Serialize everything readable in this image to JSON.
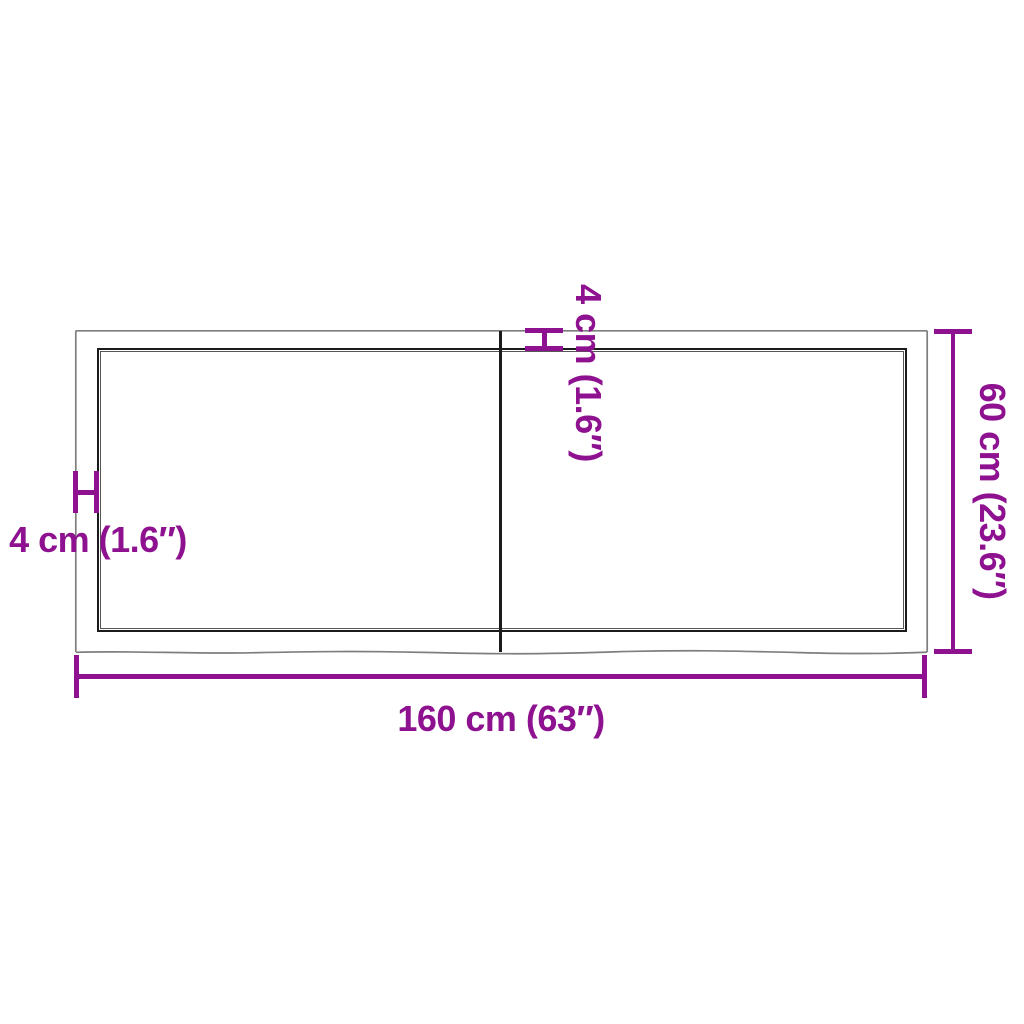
{
  "diagram": {
    "width_label": "160 cm (63″)",
    "height_label": "60 cm (23.6″)",
    "thickness_label_left": "4 cm (1.6″)",
    "thickness_label_top": "4 cm (1.6″)"
  },
  "colors": {
    "dimension": "#8E1190",
    "edge_dark": "#1b1b1b",
    "edge_light": "#7e7e7e"
  }
}
